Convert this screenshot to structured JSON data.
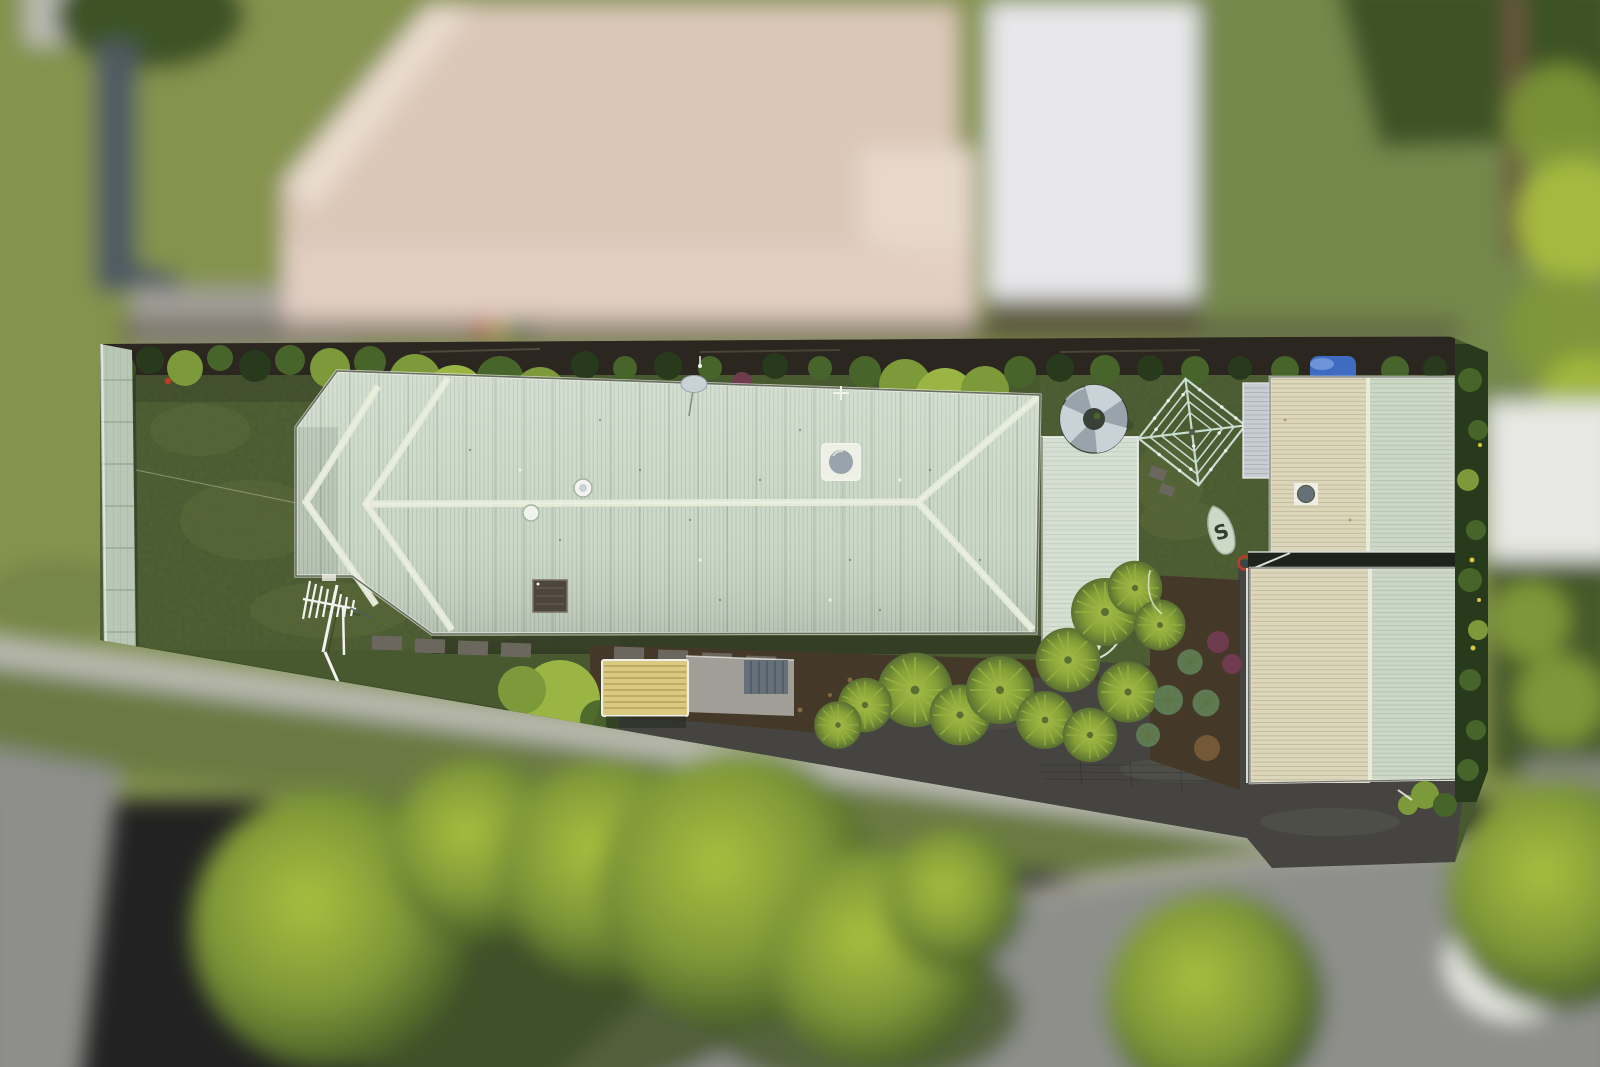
{
  "scene": {
    "type": "aerial-drone-photograph",
    "subject": "Top-down aerial view of a long narrow residential lot in sharp focus, surrounded by blurred neighbouring houses, lawns, street, footpath and trees",
    "effect": "tilt-shift: property parcel sharp, everything outside the boundary blurred",
    "width_px": 1600,
    "height_px": 1067
  },
  "objects": {
    "surfboard_logo": "S",
    "inventory": [
      "neighbouring house with beige hip roof (blurred, top)",
      "neighbouring white corrugated roof (blurred, top right)",
      "blurred street with kerb, footpath and large street trees (bottom)",
      "in-focus long pale-green corrugated hip-roof house with left wing",
      "pale sage corrugated left boundary fence",
      "rear lawn with TV antenna lying on grass",
      "satellite dish, whirlybird vents, skylight and dark vent box on roof",
      "rear skillion extension roof",
      "round galvanised rainwater tank",
      "rotary hills-hoist clothesline",
      "surfboard with S logo standing in garden",
      "two cream/green corrugated outbuildings at right",
      "tropical garden beds with palms, agaves and cordylines",
      "dark asphalt driveway",
      "dark boundary hedge at right with yellow flowers",
      "cream-yellow window awning",
      "grey patio with louvre unit",
      "blue tarp near rear fence",
      "timber rear fence with overhanging shrubs"
    ]
  },
  "palette": {
    "bgOlive": "#85934e",
    "bgOliveDark": "#6a7a42",
    "bgLawnRight": "#74884b",
    "bgTreeDark": "#3d5326",
    "bgTreeMid": "#7e9738",
    "bgTreeLime": "#aabf3e",
    "bgUnderbrush": "#46572b",
    "road": "#8e8f8b",
    "path": "#bbbbb2",
    "kerb": "#d8d3c2",
    "whitePatch": "#e7e8e3",
    "nRoofBeige": "#dbc7b8",
    "nRoofLight": "#eadcce",
    "nRoofPink": "#e3cfc3",
    "nRoofWhite": "#ededef",
    "nRoofWhiteRib": "#d8d9dd",
    "patio": "#a19e98",
    "slate": "#4e5a62",
    "shadowBand": "#55503f",
    "trunk": "#6a573d",
    "teal": "#2e4a52",
    "lotLawn": "#49592f",
    "lotLawnLight": "#5f6f3b",
    "fence": "#b9c7b6",
    "fenceLine": "#8ea68c",
    "fenceTimber": "#2b2620",
    "fenceRail": "#6b5f4d",
    "hedgeDark": "#283a1c",
    "hedgeMid": "#47642a",
    "hedgeBright": "#7d9a3b",
    "hedgeLime": "#9ab544",
    "roof": "#ccd9c8",
    "roofRib": "#a3b5a2",
    "ridge": "#e7ecd9",
    "ext": "#d5dfd2",
    "extRib": "#b2c0b1",
    "shedCream": "#dcd6ba",
    "shedCreamRib": "#b4aa8a",
    "shedGreen": "#cdd7c5",
    "shedGreenRib": "#a6b6a4",
    "shedGray": "#c8cdd2",
    "shedGrayRib": "#9aa2ab",
    "gutter": "#eef0e6",
    "gutterDark": "#555a4d",
    "mulch": "#443828",
    "chip": "#96784f",
    "chipLight": "#bb9c69",
    "asphalt": "#454440",
    "asphaltLight": "#585750",
    "paver": "#6b675e",
    "tank": "#99a3ab",
    "tankLight": "#c9d2d7",
    "tankDark": "#394038",
    "line": "#c8dcd0",
    "surf": "#ced8c6",
    "surfDark": "#31402f",
    "awning": "#d9c981",
    "awningSlat": "#ac9a4c",
    "louvre": "#667078",
    "louvreSlat": "#49525a",
    "palm": "#a9be47",
    "palmMid": "#85a037",
    "palmDark": "#597031",
    "agave": "#5e7a52",
    "cordyline": "#6f3b4e",
    "fernBrown": "#7a5c38",
    "tarp": "#3f6cc0",
    "tarpLight": "#6e94d8",
    "flower": "#d9c93a",
    "redDot": "#c23b2a",
    "toyYellow": "#cfa81f",
    "toyGreen": "#4d8a3a",
    "white": "#f2f3ee",
    "shadow": "#20231c",
    "boxDark": "#4d473b",
    "boxRim": "#7c7362"
  }
}
